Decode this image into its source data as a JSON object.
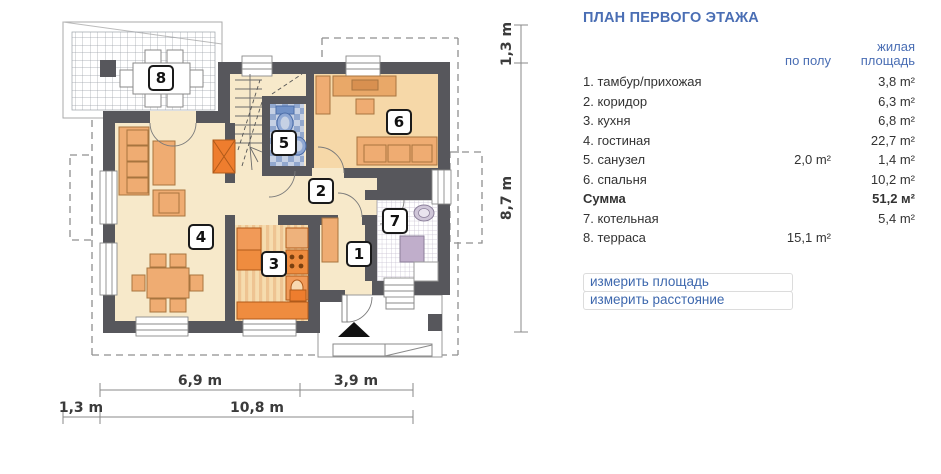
{
  "panel": {
    "title": "ПЛАН ПЕРВОГО ЭТАЖА",
    "columns": {
      "floor": "по полу",
      "living_line1": "жилая",
      "living_line2": "площадь"
    },
    "rows": [
      {
        "name": "1. тамбур/прихожая",
        "floor": "",
        "living": "3,8 m²",
        "bold": false
      },
      {
        "name": "2. коридор",
        "floor": "",
        "living": "6,3 m²",
        "bold": false
      },
      {
        "name": "3. кухня",
        "floor": "",
        "living": "6,8 m²",
        "bold": false
      },
      {
        "name": "4. гостиная",
        "floor": "",
        "living": "22,7 m²",
        "bold": false
      },
      {
        "name": "5. санузел",
        "floor": "2,0 m²",
        "living": "1,4 m²",
        "bold": false
      },
      {
        "name": "6. спальня",
        "floor": "",
        "living": "10,2 m²",
        "bold": false
      },
      {
        "name": "Сумма",
        "floor": "",
        "living": "51,2 м²",
        "bold": true
      },
      {
        "name": "7. котельная",
        "floor": "",
        "living": "5,4 m²",
        "bold": false
      },
      {
        "name": "8. терраса",
        "floor": "15,1 m²",
        "living": "",
        "bold": false
      }
    ],
    "links": [
      "измерить площадь",
      "измерить расстояние"
    ]
  },
  "plan": {
    "badges": {
      "b1": "1",
      "b2": "2",
      "b3": "3",
      "b4": "4",
      "b5": "5",
      "b6": "6",
      "b7": "7",
      "b8": "8"
    },
    "dims": {
      "right_small": "1,3 m",
      "right_big": "8,7 m",
      "bottom_inner_left": "6,9 m",
      "bottom_inner_right": "3,9 m",
      "bottom_outer_small": "1,3 m",
      "bottom_outer_big": "10,8 m"
    }
  },
  "colors": {
    "wall": "#57575c",
    "floor_cream": "#f7e9ca",
    "floor_bedroom": "#f6d8a8",
    "furniture_tan": "#efac72",
    "orange": "#ef8c3f",
    "orange_dark": "#ee7d2e",
    "tile_blue_light": "#c6d1e4",
    "tile_blue_dark": "#92a8ce",
    "fixture_blue": "#8fa8d4",
    "boiler_purple": "#c0aecb",
    "dash_gray": "#8f8f8f",
    "accent_blue": "#4a6eb4",
    "link_blue": "#3e68ae"
  }
}
